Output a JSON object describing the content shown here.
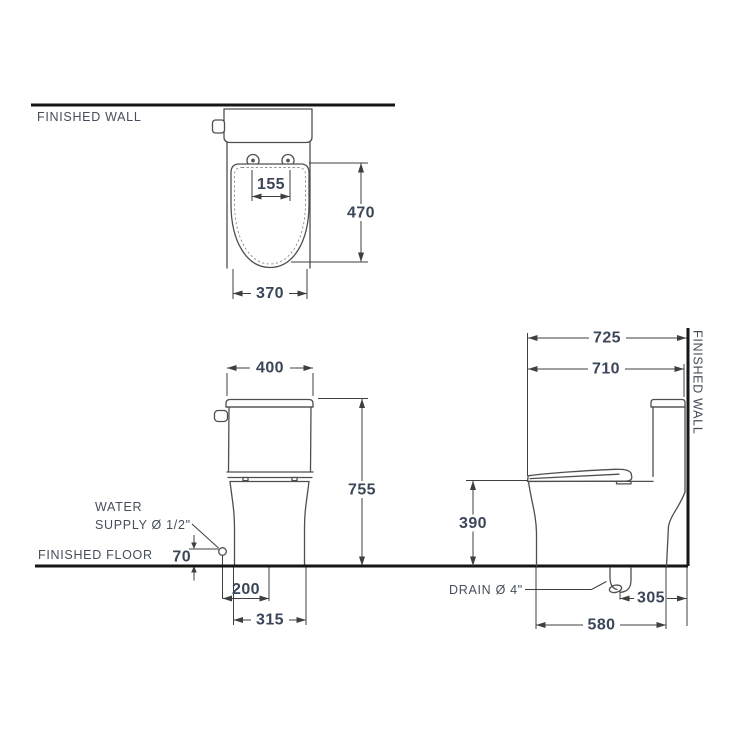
{
  "colors": {
    "line": "#4f4f4f",
    "dim": "#3f3f3f",
    "heavy": "#161616",
    "label": "#454e5a",
    "number": "#3b4658",
    "bg": "#ffffff"
  },
  "labels": {
    "finished_wall_top": "FINISHED WALL",
    "finished_floor": "FINISHED FLOOR",
    "finished_wall_side": "FINISHED WALL",
    "water_supply_line1": "WATER",
    "water_supply_line2": "SUPPLY Ø 1/2\"",
    "drain": "DRAIN Ø 4\""
  },
  "dimensions_mm": {
    "top_view": {
      "hinge_hole_spacing": "155",
      "bowl_length": "470",
      "bowl_width": "370"
    },
    "front_view": {
      "tank_width": "400",
      "overall_height": "755",
      "water_supply_height": "70",
      "water_supply_offset": "200",
      "base_width": "315"
    },
    "side_view": {
      "overall_depth": "725",
      "depth_to_tank": "710",
      "rim_height": "390",
      "drain_to_wall": "305",
      "base_depth": "580"
    }
  }
}
